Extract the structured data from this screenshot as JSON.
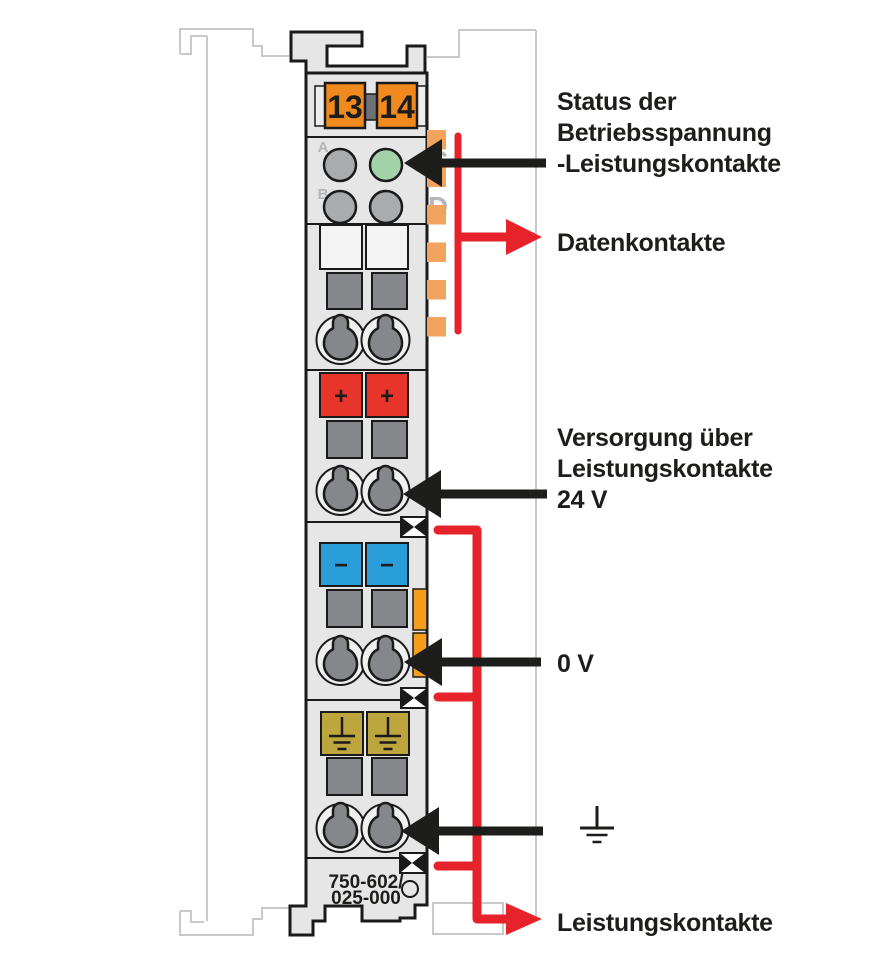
{
  "module": {
    "order_number_line1": "750-602/",
    "order_number_line2": "025-000",
    "terminal_numbers": [
      "13",
      "14"
    ],
    "led_labels": [
      "A",
      "B",
      "C",
      "D"
    ],
    "plus_symbol": "+",
    "minus_symbol": "−"
  },
  "annotations": {
    "status_label": [
      "Status der",
      "Betriebsspannung",
      "-Leistungskontakte"
    ],
    "data_contacts_label": "Datenkontakte",
    "supply_label": [
      "Versorgung über",
      "Leistungskontakte",
      "24 V"
    ],
    "zero_volt_label": "0 V",
    "power_contacts_label": "Leistungskontakte"
  },
  "colors": {
    "body_gray": "#e6e6e7",
    "outline_black": "#1a1a1a",
    "ghost_gray": "#c9c9cb",
    "led_gray": "#a9abad",
    "led_green": "#a3d2a8",
    "terminal_orange": "#f18a1e",
    "data_contact_orange": "#f2a45f",
    "lever_orange": "#f59d1c",
    "plus_red": "#e8352b",
    "minus_blue": "#2a9ed9",
    "earth_olive": "#bda63e",
    "dark_gray": "#85878a",
    "arrow_black": "#1d1d1b",
    "arrow_red": "#e6232a",
    "label_text": "#1d1d1b"
  }
}
